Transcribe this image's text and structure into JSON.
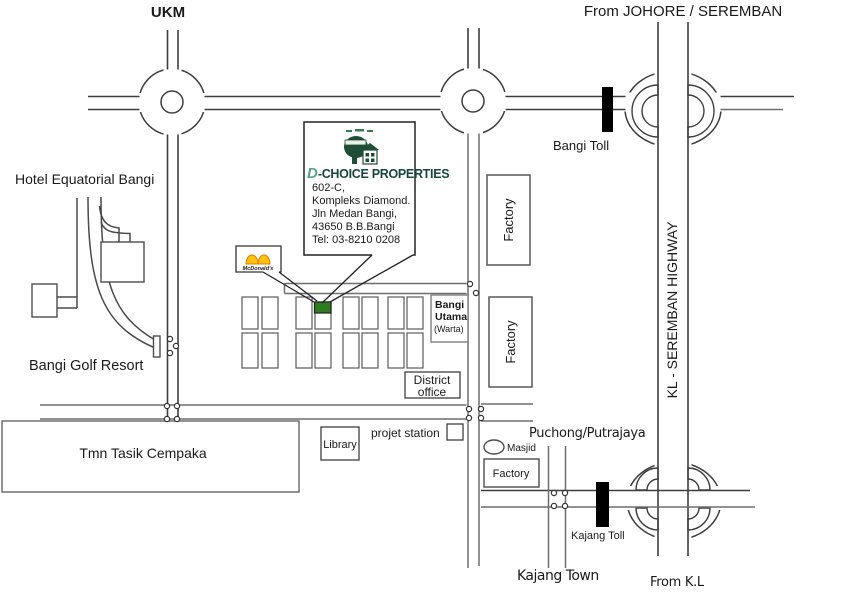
{
  "map": {
    "labels": {
      "ukm": "UKM",
      "from_johore": "From JOHORE / SEREMBAN",
      "hotel_equatorial": "Hotel Equatorial Bangi",
      "bangi_golf": "Bangi Golf Resort",
      "bangi_toll": "Bangi Toll",
      "kl_seremban_highway": "KL - SEREMBAN HIGHWAY",
      "factory_upper": "Factory",
      "factory_lower": "Factory",
      "factory_south": "Factory",
      "bangi_utama_line1": "Bangi",
      "bangi_utama_line2": "Utama",
      "bangi_utama_line3": "(Warta)",
      "district_line1": "District",
      "district_line2": "office",
      "library": "Library",
      "projet_station": "projet station",
      "tmn_tasik": "Tmn Tasik Cempaka",
      "puchong": "Puchong/Putrajaya",
      "masjid": "Masjid",
      "kajang_toll": "Kajang Toll",
      "kajang_town": "Kajang Town",
      "from_kl": "From K.L"
    },
    "dchoice": {
      "brand_d": "D",
      "brand_rest": "-CHOICE PROPERTIES",
      "address_lines": [
        "602-C,",
        "Kompleks Diamond.",
        "Jln Medan Bangi,",
        "43650 B.B.Bangi",
        "Tel: 03-8210 0208"
      ]
    },
    "mcdonalds": {
      "name": "McDonald's"
    },
    "colors": {
      "highlight_lot": "#2e7c1f",
      "brand_green": "#17463b",
      "brand_d_teal": "#55a18a",
      "logo_green": "#1f4d35",
      "mcd_yellow": "#ffc20e",
      "mcd_orange": "#e07b00",
      "mcd_red": "#d42b1e",
      "toll_black": "#000000"
    }
  }
}
